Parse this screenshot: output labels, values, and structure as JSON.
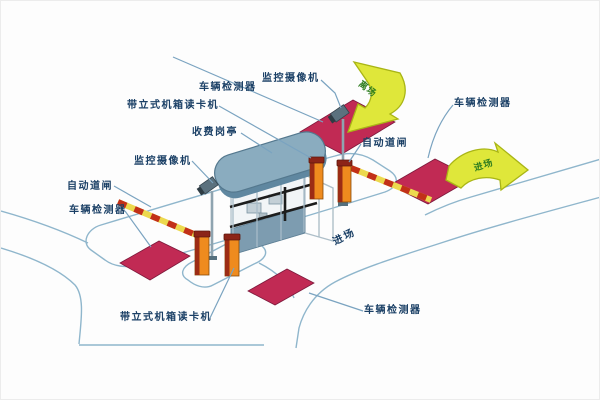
{
  "diagram": {
    "type": "parking-lot-entrance-exit-management-system",
    "callouts": [
      {
        "text": "车辆检测器"
      },
      {
        "text": "监控摄像机"
      },
      {
        "text": "带立式机箱读卡机"
      },
      {
        "text": "收费岗亭"
      },
      {
        "text": "监控摄像机"
      },
      {
        "text": "自动道闸"
      },
      {
        "text": "车辆检测器"
      },
      {
        "text": "自动道闸"
      },
      {
        "text": "车辆检测器"
      },
      {
        "text": "带立式机箱读卡机"
      },
      {
        "text": "车辆检测器"
      }
    ],
    "arrows": {
      "exit": {
        "text": "离场"
      },
      "entry": {
        "text": "进场"
      }
    },
    "road_text": "进场"
  },
  "colors": {
    "label_text": "#1b4066",
    "leader_line": "#7aa3c0",
    "road_line": "#8fb6cc",
    "detector_pad": "#c12a54",
    "arrow_fill": "#dfe73a",
    "arrow_text": "#2e7d1f",
    "booth_roof": "#8aacbf",
    "booth_panel": "#7d9cb0",
    "machine_orange": "#ef8b1e",
    "machine_maroon": "#8c2418",
    "barrier_arm_yellow": "#ecd94e",
    "barrier_arm_red": "#c23018",
    "camera_body": "#5b717e"
  }
}
